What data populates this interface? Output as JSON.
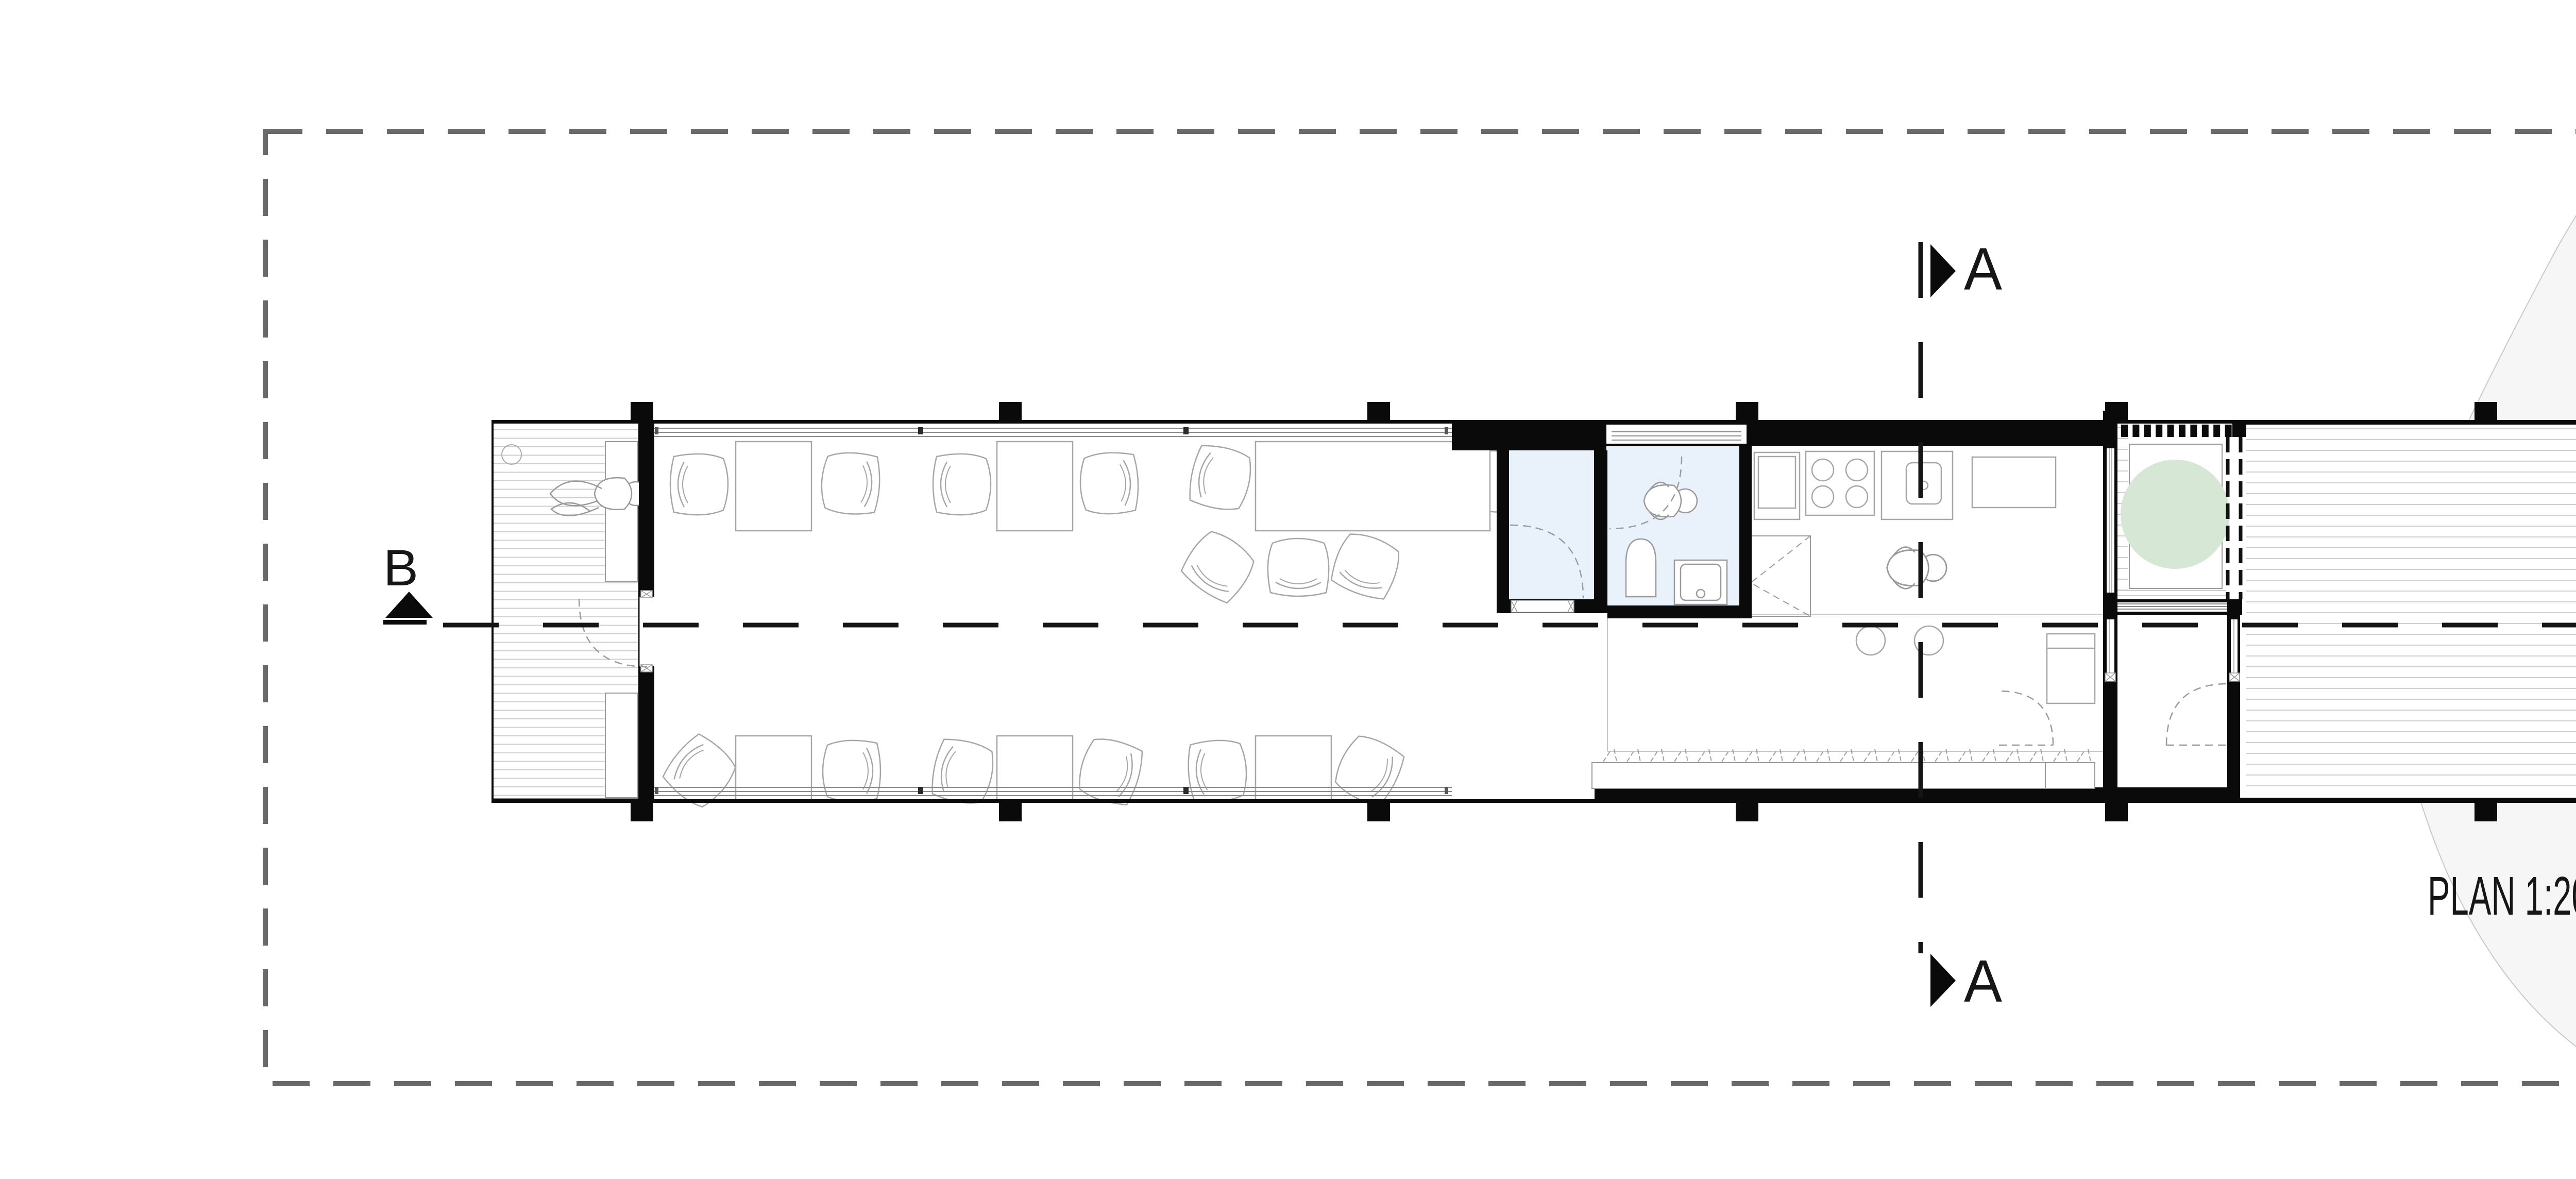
{
  "labels": {
    "plan_scale": "PLAN 1:200",
    "section_a": "A",
    "section_b": "B",
    "north": "N"
  },
  "drawing": {
    "kind": "architectural floor plan",
    "scale": "1:200",
    "visible_section_marker_letters": [
      "A",
      "A",
      "B",
      "B"
    ],
    "north_arrow": "tilted compass arrow, black/white blades"
  },
  "colors": {
    "paper": "#ffffff",
    "site_halo_gray": "#f5f6f5",
    "site_inner_gray": "#eaebea",
    "site_circle_gray": "#d9dbd9",
    "wet_room_blue": "#e9f1fb",
    "tree_green": "#d6e7d5",
    "wall_black": "#0a0a0a",
    "furniture_line_gray": "#a6a6a6",
    "deck_plank_gray": "#cfcfcf",
    "boundary_dash_gray": "#696969"
  },
  "scene_elements": [
    "left-terrace-deck",
    "lounging-person",
    "open-office-desks",
    "meeting-table",
    "wc-core-two-blue-rooms",
    "toilet",
    "shower",
    "kitchen-counter",
    "cooktop",
    "sink",
    "island-stools",
    "standing-person",
    "planter-bench-with-grass",
    "courtyard-tree",
    "louver-screen",
    "entry-vestibule",
    "right-terrace-deck",
    "site-path",
    "site-circle",
    "property-boundary"
  ]
}
